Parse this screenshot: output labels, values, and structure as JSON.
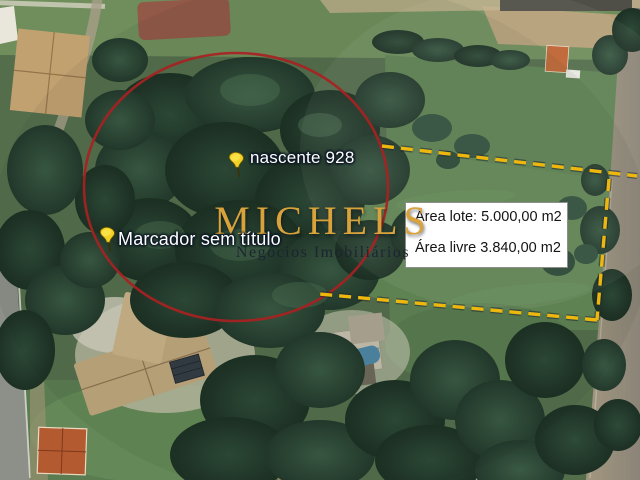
{
  "map": {
    "markers": [
      {
        "label": "nascente 928"
      },
      {
        "label": "Marcador sem título"
      }
    ],
    "info_box": {
      "line1": "Área lote: 5.000,00 m2",
      "line2": "Área livre 3.840,00 m2"
    },
    "watermark": {
      "title": "MICHELS",
      "subtitle": "Negócios Imobiliários"
    },
    "colors": {
      "circle_red": "#a82222",
      "boundary_dash": "#eeb70e",
      "pin_yellow": "#f2d024",
      "watermark_gold": "#d9a23a",
      "watermark_dark": "#1b2330",
      "label_text": "#ffffff",
      "info_text": "#141414"
    }
  }
}
